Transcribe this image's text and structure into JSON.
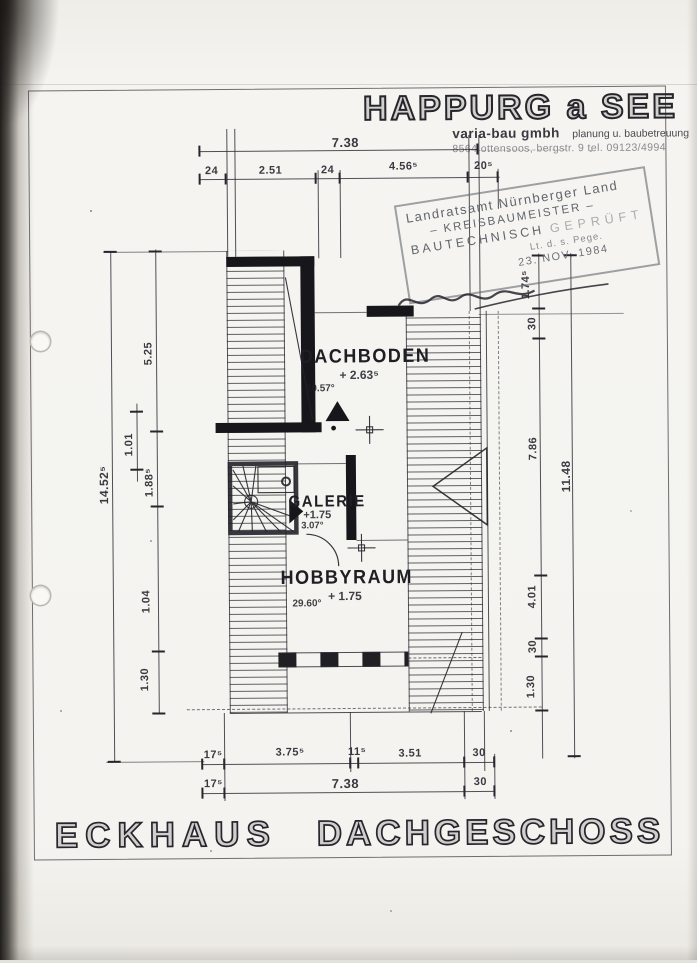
{
  "header": {
    "title": "HAPPURG a SEE",
    "firm_name": "varia-bau gmbh",
    "firm_tagline": "planung u. baubetreuung",
    "firm_address": "8564 ottensoos, bergstr. 9  tel. 09123/4994"
  },
  "stamp": {
    "line1": "Landratsamt Nürnberger Land",
    "line2": "– KREISBAUMEISTER –",
    "line3a": "BAUTECHNISCH",
    "line3b": "GEPRÜFT",
    "line4": "Lt. d. s. Pege.",
    "date": "23. NOV. 1984"
  },
  "rooms": {
    "dachboden": {
      "name": "DACHBODEN",
      "level": "+ 2.63⁵",
      "angle": "30.57°"
    },
    "galerie": {
      "name": "GALERIE",
      "level": "+1.75",
      "angle": "3.07°"
    },
    "hobbyraum": {
      "name": "HOBBYRAUM",
      "level": "+ 1.75",
      "angle": "29.60°"
    }
  },
  "dimensions": {
    "top_total": "7.38",
    "top_chain": [
      "24",
      "2.51",
      "24",
      "4.56⁵",
      "20⁵"
    ],
    "left_outer": "14.52⁵",
    "left_chain": [
      "5.25",
      "1.01",
      "1.88⁵",
      "1.04",
      "1.30"
    ],
    "right_chain": [
      "1.74⁵",
      "30",
      "7.86",
      "4.01",
      "30",
      "1.30"
    ],
    "right_outer": "11.48",
    "bottom_chain": [
      "17⁵",
      "3.75⁵",
      "11⁵",
      "3.51",
      "30"
    ],
    "bottom_total": [
      "17⁵",
      "7.38",
      "30"
    ]
  },
  "footer": {
    "left_title": "ECKHAUS",
    "right_title": "DACHGESCHOSS"
  }
}
